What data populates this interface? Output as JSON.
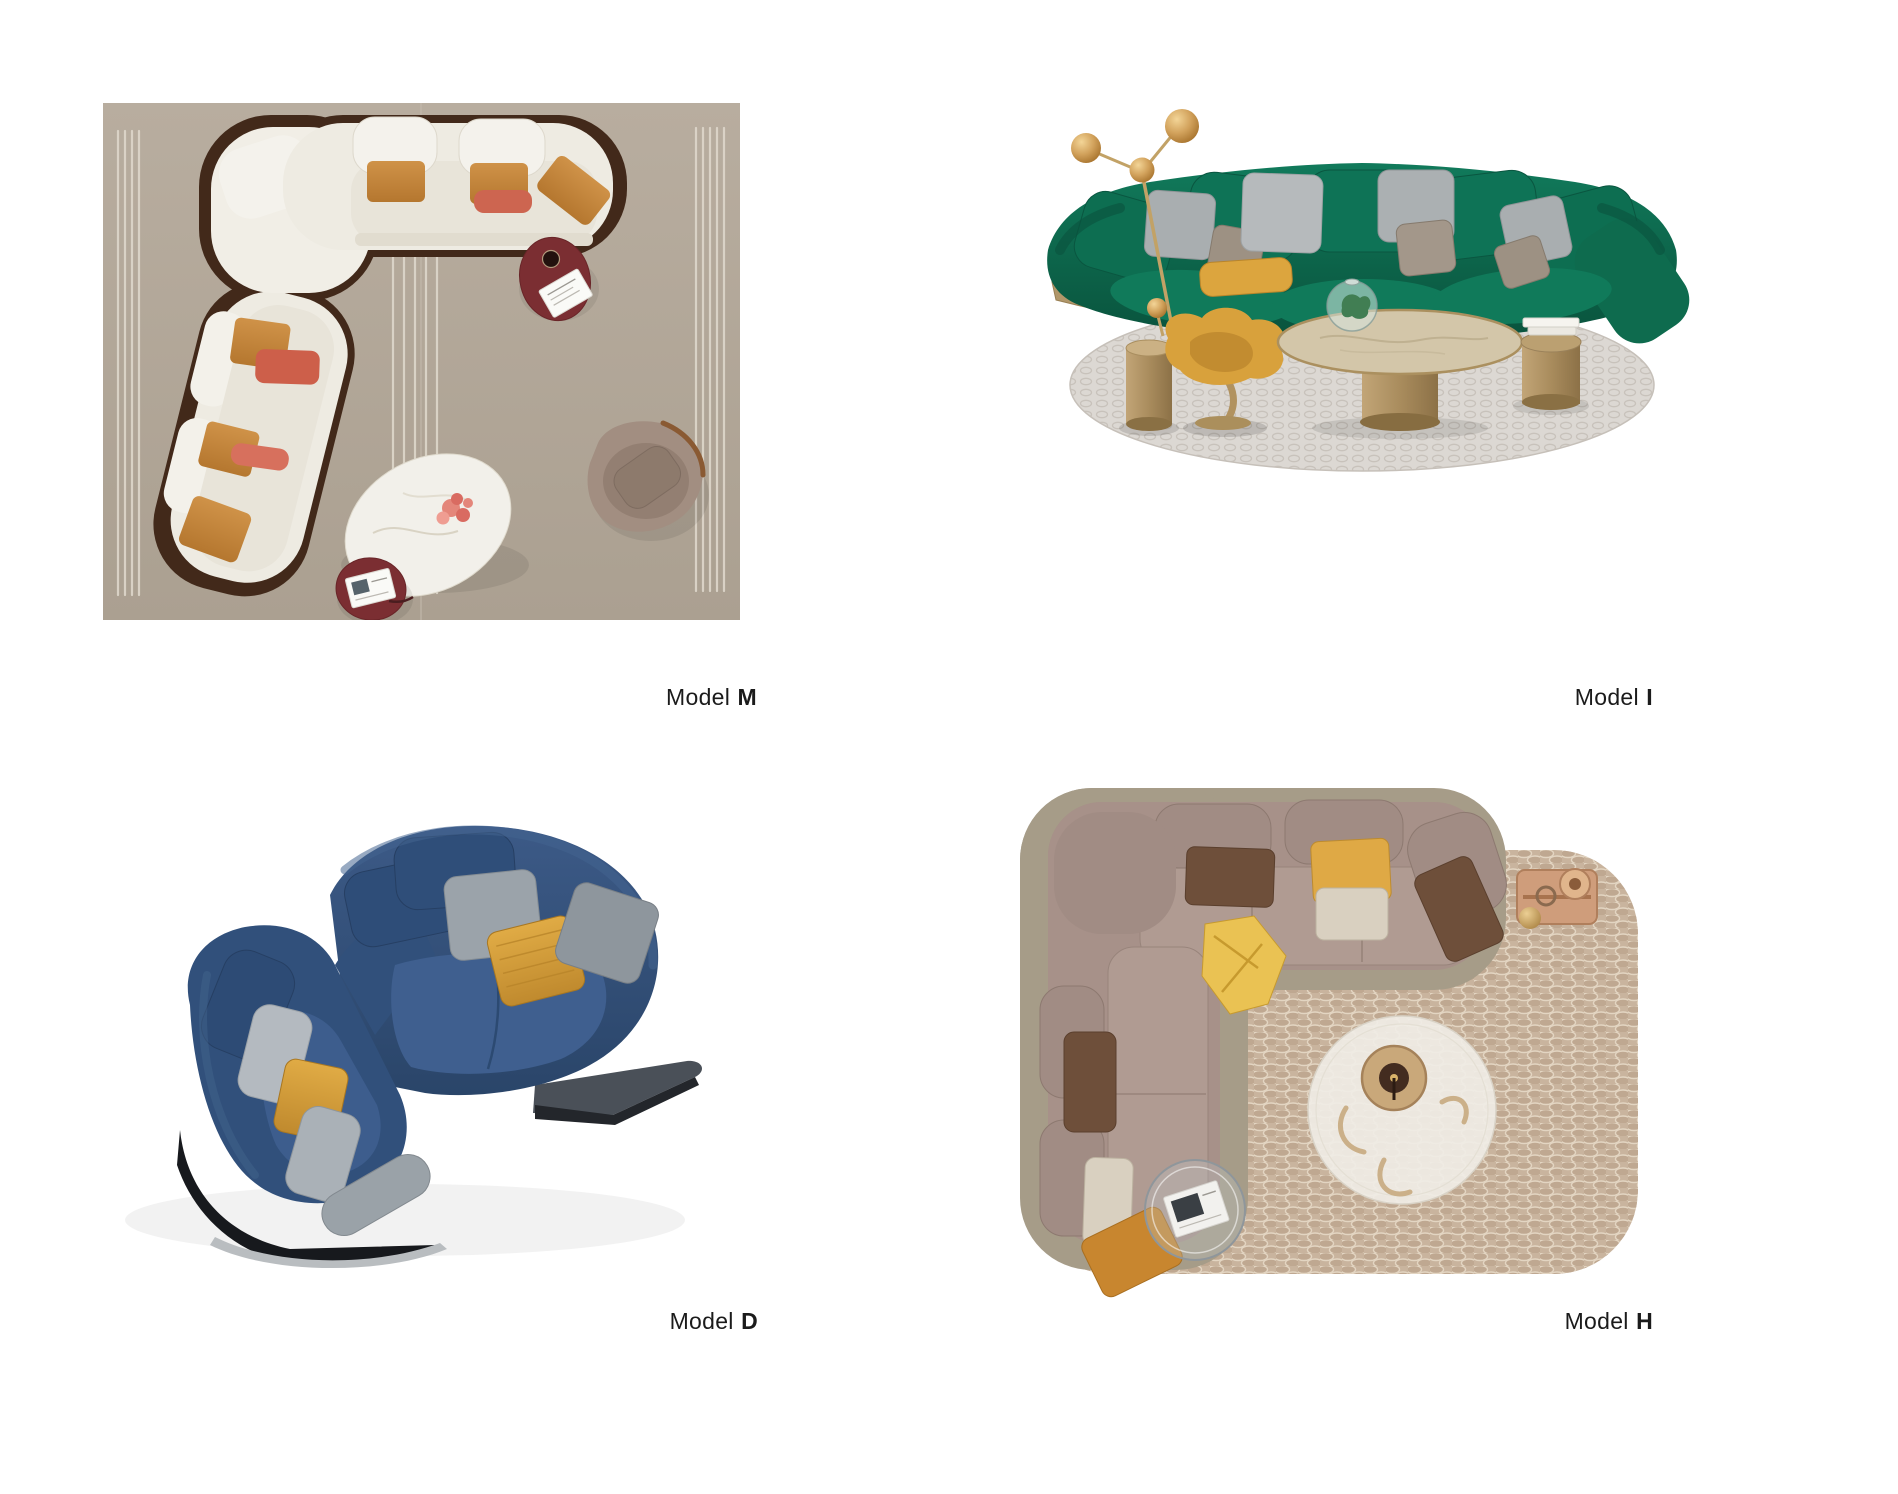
{
  "page": {
    "background_color": "#ffffff"
  },
  "catalog": {
    "products": [
      {
        "id": "model-m",
        "label_prefix": "Model",
        "label_letter": "M",
        "photo_alt": "Top view of a cream curved sectional sofa with walnut trim, amber and coral cushions, organic white coffee table, burgundy side tables and an armchair on a striped beige rug",
        "colors": {
          "rug": "#b3a79b",
          "stripe": "#ded7cb",
          "sofa": "#efece4",
          "wood": "#42291a",
          "pillow_amber": "#c8893f",
          "pillow_coral": "#cd6550",
          "side_table": "#7b2e32",
          "coffee_table": "#f2f0ea",
          "armchair": "#a28e81"
        }
      },
      {
        "id": "model-i",
        "label_prefix": "Model",
        "label_letter": "I",
        "photo_alt": "Emerald green curved velvet sofa with grey and taupe cushions on a round patterned rug, brass floor lamp, yellow swivel chair, marble coffee table and brass side tables",
        "colors": {
          "sofa": "#0d6e51",
          "rug": "#dcd8d3",
          "gold": "#b1976a",
          "chair": "#d8a13c",
          "pillow_grey": "#a9aeb0",
          "pillow_yellow": "#dca53e",
          "marble": "#d3c6a9"
        }
      },
      {
        "id": "model-d",
        "label_prefix": "Model",
        "label_letter": "D",
        "photo_alt": "Blue velvet curved sectional sofa seen from above with grey and mustard cushions on a dark platform base",
        "colors": {
          "sofa": "#33517c",
          "seat": "#3f5f8f",
          "base": "#17191d",
          "platform": "#4a5058",
          "pillow_grey": "#9ba3aa",
          "pillow_mustard": "#d9a33c"
        }
      },
      {
        "id": "model-h",
        "label_prefix": "Model",
        "label_letter": "H",
        "photo_alt": "Top view of a taupe corner sectional sofa with brown, yellow and cream cushions on a beige honeycomb rug with round marble table, glass side table and copper tray",
        "colors": {
          "sofa": "#a79189",
          "base": "#a69c88",
          "rug": "#c9b49e",
          "pillow_brown": "#6e4f3a",
          "pillow_yellow": "#dfa945",
          "pillow_orange": "#c8862f",
          "tray_copper": "#cf9d7b",
          "table": "#efece6"
        }
      }
    ]
  }
}
